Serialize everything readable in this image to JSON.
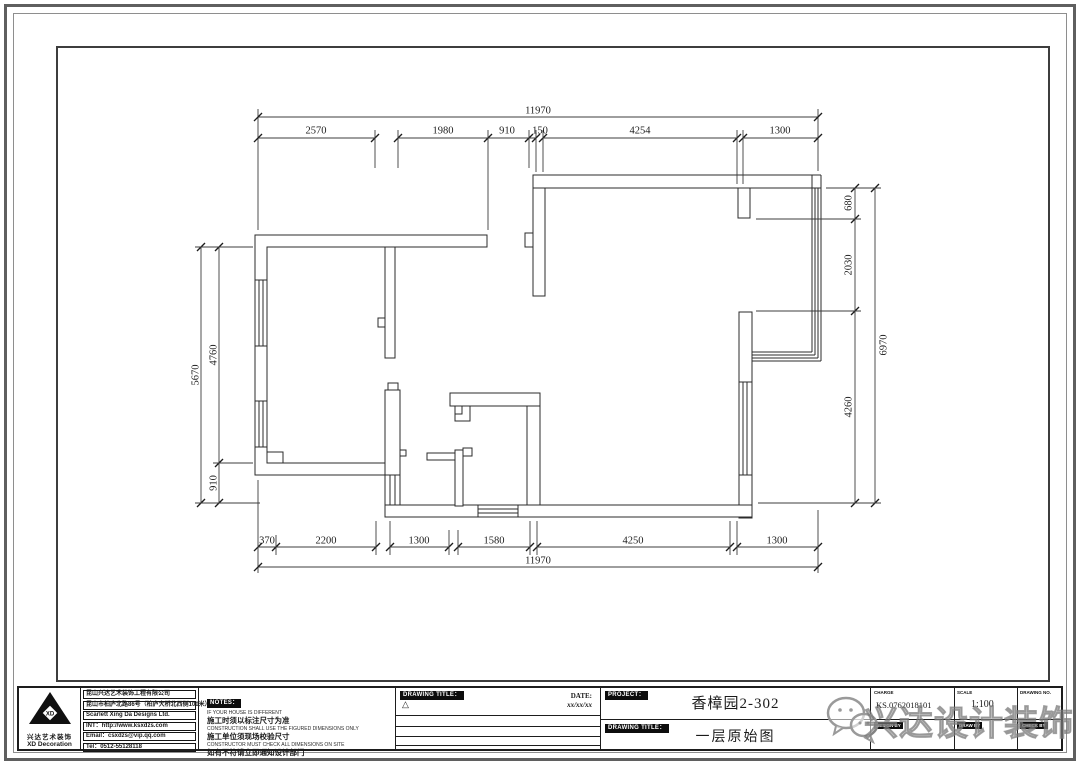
{
  "sheet": {
    "watermark_text": "兴达设计装饰"
  },
  "plan": {
    "dims": {
      "top_total": "11970",
      "top_segments": [
        "2570",
        "1980",
        "910",
        "150",
        "4254",
        "1300"
      ],
      "bottom_segments": [
        "370",
        "2200",
        "1300",
        "1580",
        "4250",
        "1300"
      ],
      "bottom_total": "11970",
      "left_total": "5670",
      "left_segments": [
        "4760",
        "910"
      ],
      "right_segments": [
        "680",
        "2030",
        "4260"
      ],
      "right_total": "6970"
    }
  },
  "title_block": {
    "logo": {
      "monogram": "XD",
      "name_cn": "兴达艺术装饰",
      "name_en": "XD Decoration"
    },
    "company": {
      "line1": "昆山兴达艺术装饰工程有限公司",
      "line2": "昆山市柏庐北路86号（柏庐大桥北西侧100米）",
      "line3": "Scarlett Xing Da Designs Ltd.",
      "line4": "INT：http://www.ksxdzs.com",
      "line5": "Email：csxdzs@vip.qq.com",
      "line6": "Tel：0512-55128118"
    },
    "notes": {
      "header": "NOTES：",
      "en1": "IF YOUR HOUSE IS DIFFERENT",
      "cn1": "施工时须以标注尺寸为准",
      "en2": "CONSTRUCTION SHALL USE THE FIGURED DIMENSIONS ONLY",
      "cn2": "施工单位须现场校验尺寸",
      "en3": "CONSTRUCTOR MUST CHECK ALL DIMENSIONS ON SITE",
      "cn3": "如有不符请立即通知设计部门"
    },
    "revisions": {
      "header": "DRAWING TITLE：",
      "date_label": "DATE:",
      "date_value": "xx/xx/xx",
      "delta": "△"
    },
    "project": {
      "header": "PROJECT：",
      "name": "香樟园2-302",
      "drawing_header": "DRAWING TITLE：",
      "drawing_name": "一层原始图"
    },
    "info": {
      "charge_label": "CHARGE",
      "charge_value": "KS.0762018101",
      "scale_label": "SCALE",
      "scale_value": "1:100",
      "drawing_no_label": "DRAWING NO.",
      "sign_labels": [
        "DESIGN BY",
        "DRAW BY",
        "CHECK BY"
      ]
    }
  }
}
